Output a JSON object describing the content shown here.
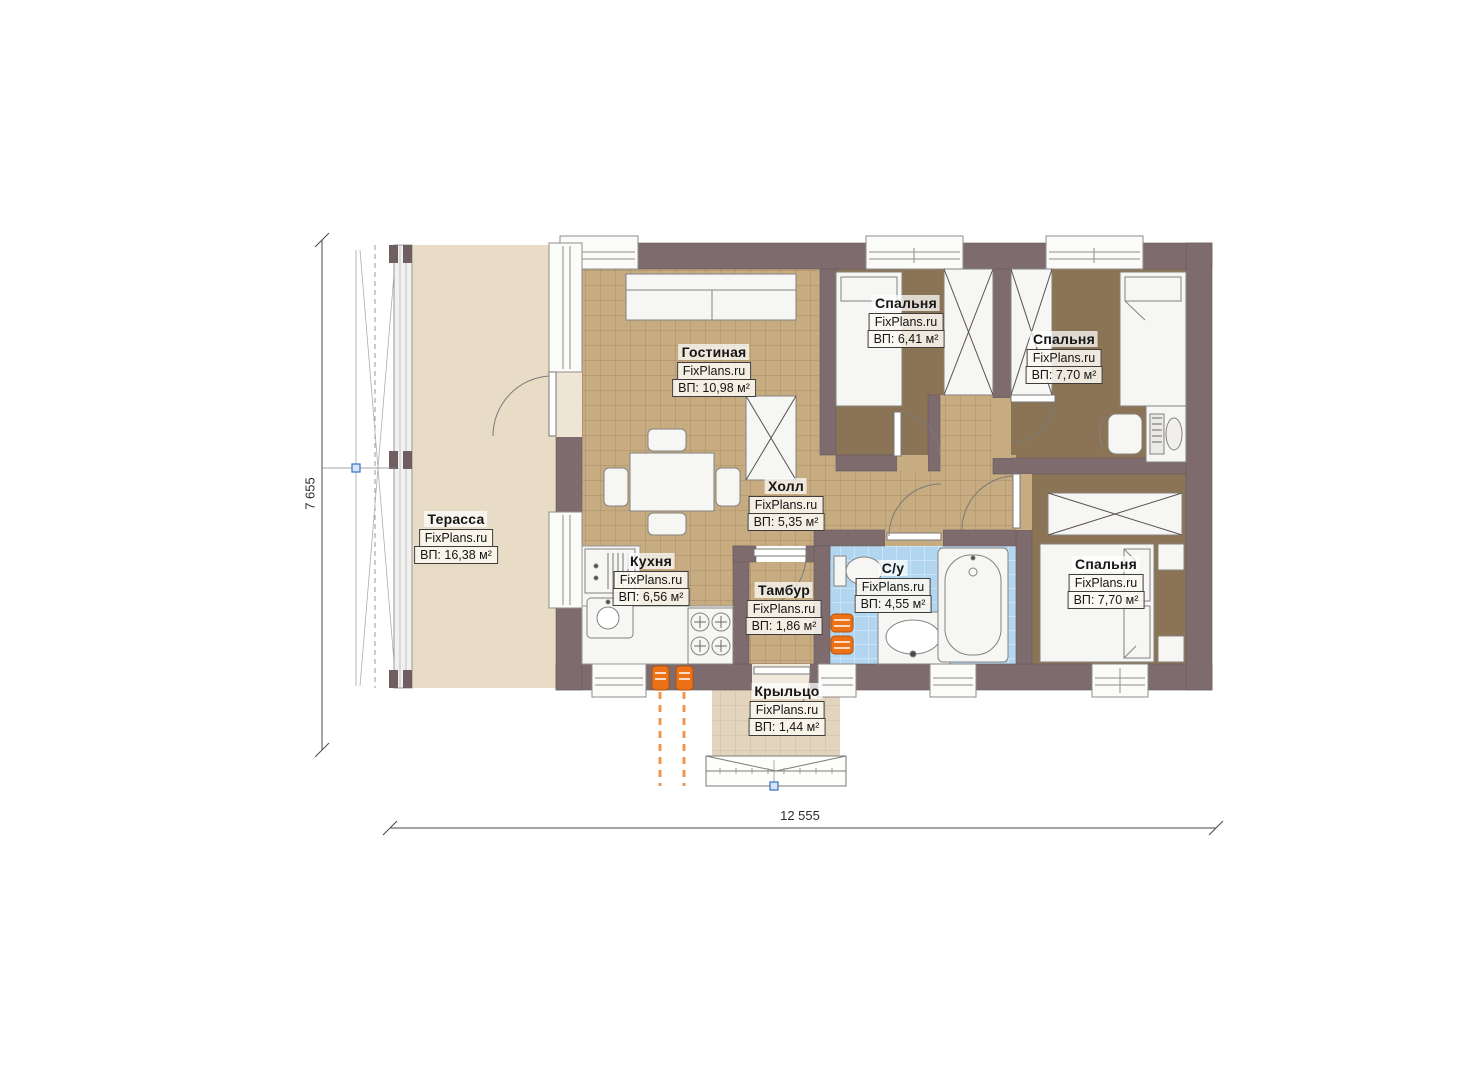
{
  "watermark": "FixPlans.ru",
  "rooms": [
    {
      "name": "Терасса",
      "area": "ВП: 16,38 м²"
    },
    {
      "name": "Гостиная",
      "area": "ВП: 10,98 м²"
    },
    {
      "name": "Спальня",
      "area": "ВП: 6,41 м²"
    },
    {
      "name": "Спальня",
      "area": "ВП: 7,70 м²"
    },
    {
      "name": "Холл",
      "area": "ВП: 5,35 м²"
    },
    {
      "name": "Кухня",
      "area": "ВП: 6,56 м²"
    },
    {
      "name": "Тамбур",
      "area": "ВП: 1,86 м²"
    },
    {
      "name": "С/у",
      "area": "ВП: 4,55 м²"
    },
    {
      "name": "Спальня",
      "area": "ВП: 7,70 м²"
    },
    {
      "name": "Крыльцо",
      "area": "ВП: 1,44 м²"
    }
  ],
  "dimensions": {
    "height": "7 655",
    "width": "12 555"
  },
  "colors": {
    "wall": "#7d6b6d",
    "tile_floor": "#c7ab81",
    "bedroom_carpet": "#8b7355",
    "bathroom_tile": "#b3d6f0",
    "terrace": "#e8dcc6",
    "porch": "#e3d5bd",
    "radiator": "#ed7117",
    "marker_blue": "#3a6fc4"
  }
}
